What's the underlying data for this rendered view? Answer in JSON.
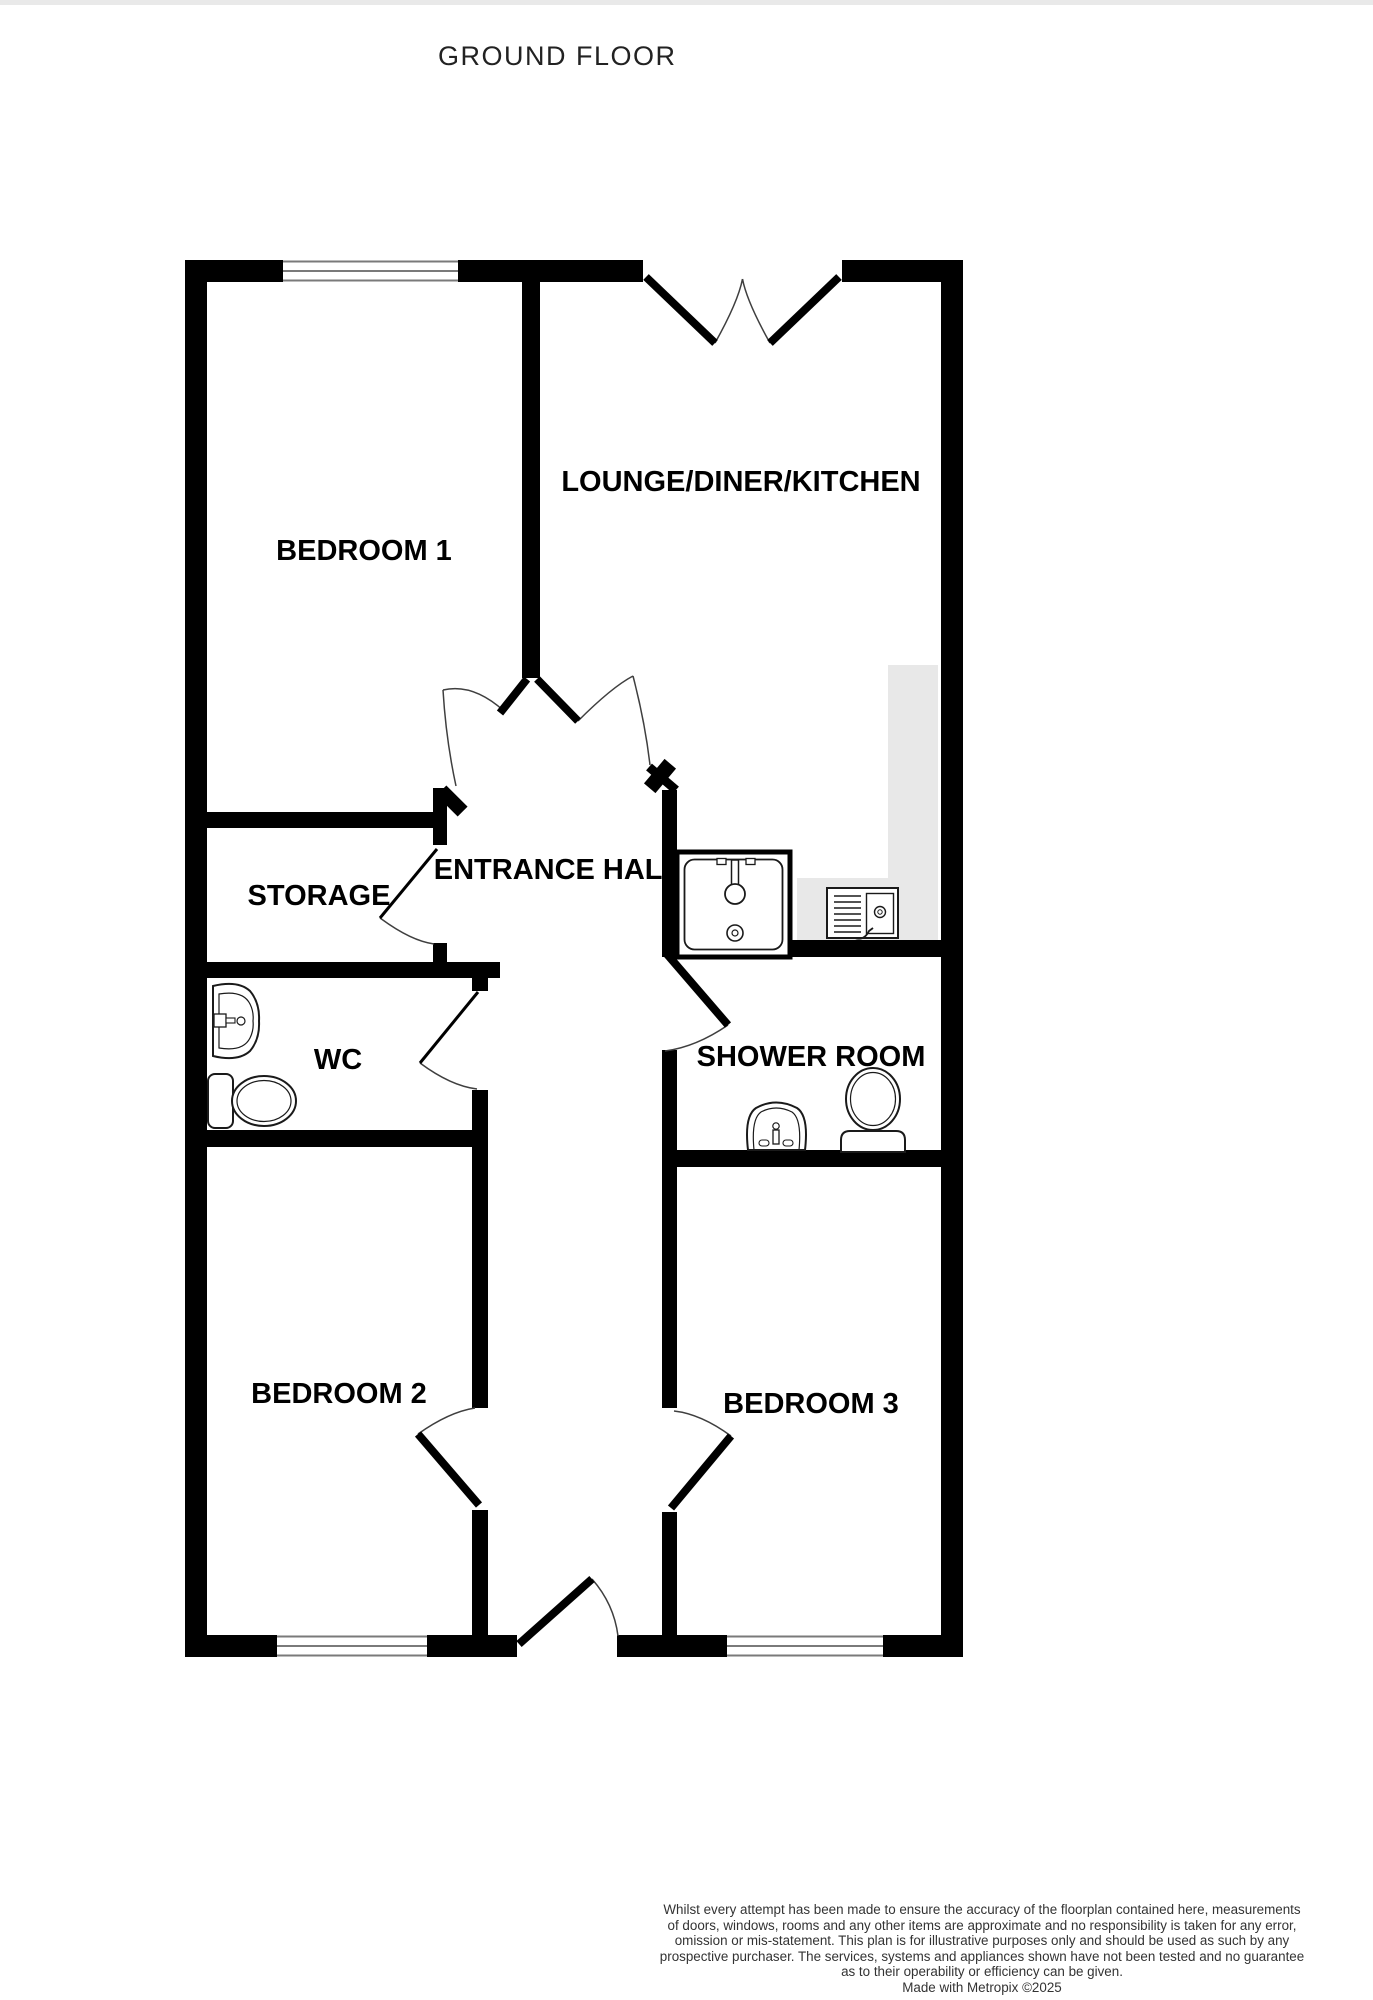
{
  "page": {
    "title": "GROUND FLOOR",
    "top_strip_color": "#e9e9e9"
  },
  "floorplan": {
    "colors": {
      "wall": "#000000",
      "arc": "#3f3f3f",
      "window_line": "#7a7a7a",
      "counter": "#e8e8e8",
      "fixture": "#1a1a1a"
    },
    "rooms": [
      {
        "id": "bedroom-1",
        "label": "BEDROOM 1",
        "x": 364,
        "y": 551
      },
      {
        "id": "lounge-diner-kitchen",
        "label": "LOUNGE/DINER/KITCHEN",
        "x": 741,
        "y": 482
      },
      {
        "id": "storage",
        "label": "STORAGE",
        "x": 319,
        "y": 896
      },
      {
        "id": "entrance-hall",
        "label": "ENTRANCE HALL",
        "x": 557,
        "y": 870
      },
      {
        "id": "wc",
        "label": "WC",
        "x": 338,
        "y": 1060
      },
      {
        "id": "shower-room",
        "label": "SHOWER ROOM",
        "x": 811,
        "y": 1057
      },
      {
        "id": "bedroom-2",
        "label": "BEDROOM 2",
        "x": 339,
        "y": 1394
      },
      {
        "id": "bedroom-3",
        "label": "BEDROOM 3",
        "x": 811,
        "y": 1404
      }
    ],
    "counters": [
      [
        888,
        665,
        50,
        275
      ],
      [
        797,
        878,
        141,
        62
      ]
    ],
    "windows": [
      [
        283,
        260,
        175,
        22
      ],
      [
        277,
        1635,
        150,
        22
      ],
      [
        727,
        1635,
        156,
        22
      ]
    ],
    "walls": [
      [
        185,
        260,
        22,
        1397
      ],
      [
        941,
        260,
        22,
        1397
      ],
      [
        185,
        260,
        98,
        22
      ],
      [
        458,
        260,
        185,
        22
      ],
      [
        842,
        260,
        121,
        22
      ],
      [
        185,
        1635,
        92,
        22
      ],
      [
        427,
        1635,
        90,
        22
      ],
      [
        617,
        1635,
        110,
        22
      ],
      [
        883,
        1635,
        80,
        22
      ],
      [
        522,
        282,
        18,
        396
      ],
      [
        185,
        812,
        262,
        16
      ],
      [
        433,
        788,
        14,
        57
      ],
      [
        433,
        943,
        14,
        19
      ],
      [
        185,
        962,
        315,
        16
      ],
      [
        472,
        978,
        16,
        13
      ],
      [
        185,
        1130,
        303,
        17
      ],
      [
        472,
        1090,
        16,
        318
      ],
      [
        472,
        1510,
        16,
        147
      ],
      [
        662,
        790,
        15,
        167
      ],
      [
        662,
        1050,
        15,
        358
      ],
      [
        662,
        1512,
        15,
        145
      ],
      [
        662,
        940,
        301,
        17
      ],
      [
        662,
        1150,
        301,
        17
      ]
    ],
    "angled_walls": [
      {
        "x": 452,
        "y": 801,
        "w": 30,
        "h": 14,
        "a": 45
      },
      {
        "x": 660,
        "y": 776,
        "w": 32,
        "h": 15,
        "a": -50
      }
    ],
    "doors": [
      {
        "name": "patio-door-left",
        "leaf": [
          646,
          277,
          715,
          343
        ],
        "lw": 8,
        "arc": "M715,343 Q738,302 742.5,279"
      },
      {
        "name": "patio-door-right",
        "leaf": [
          839,
          277,
          770,
          343
        ],
        "lw": 8,
        "arc": "M770,343 Q747,302 742.5,279"
      },
      {
        "name": "bedroom-1-door",
        "leaf": [
          527,
          679,
          500,
          713
        ],
        "lw": 8,
        "arc": "M443,690 Q473,683 504,711"
      },
      {
        "name": "bedroom-1-door-swing",
        "arc": "M443,690 Q446,740 456,786"
      },
      {
        "name": "lounge-door",
        "leaf": [
          537,
          679,
          578,
          721
        ],
        "lw": 8,
        "arc": "M578,721 Q612,687 633,676"
      },
      {
        "name": "kitchen-door",
        "leaf": [
          649,
          767,
          676,
          790
        ],
        "lw": 9,
        "arc": "M633,676 Q645,722 650,765"
      },
      {
        "name": "storage-door",
        "leaf": [
          437,
          849,
          380,
          918
        ],
        "lw": 3,
        "arc": "M380,918 Q411,941 434,944"
      },
      {
        "name": "wc-door",
        "leaf": [
          478,
          992,
          420,
          1063
        ],
        "lw": 3,
        "arc": "M420,1063 Q451,1086 477,1089"
      },
      {
        "name": "shower-room-door",
        "leaf": [
          666,
          953,
          728,
          1025
        ],
        "lw": 8,
        "arc": "M728,1025 Q696,1047 665,1051"
      },
      {
        "name": "bedroom-2-door",
        "leaf": [
          479,
          1505,
          418,
          1434
        ],
        "lw": 8,
        "arc": "M418,1434 Q449,1412 475,1408"
      },
      {
        "name": "bedroom-3-door",
        "leaf": [
          671,
          1508,
          731,
          1436
        ],
        "lw": 8,
        "arc": "M731,1436 Q701,1414 674,1411"
      },
      {
        "name": "front-door",
        "leaf": [
          519,
          1644,
          592,
          1579
        ],
        "lw": 8,
        "arc": "M592,1579 Q614,1604 618,1636"
      }
    ],
    "fixtures": [
      {
        "name": "kitchen-sink",
        "shapes": [
          {
            "t": "rect",
            "x": 677,
            "y": 852,
            "w": 113,
            "h": 105,
            "fill": "#ffffff",
            "s": "#000000",
            "sw": 5
          },
          {
            "t": "rect",
            "x": 684.5,
            "y": 859.5,
            "w": 98,
            "h": 90,
            "rx": 10,
            "fill": "#ffffff",
            "sw": 1.8
          },
          {
            "t": "rect",
            "x": 717,
            "y": 858.5,
            "w": 9,
            "h": 6,
            "fill": "#ffffff",
            "sw": 1.3
          },
          {
            "t": "rect",
            "x": 746,
            "y": 858.5,
            "w": 9,
            "h": 6,
            "fill": "#ffffff",
            "sw": 1.3
          },
          {
            "t": "rect",
            "x": 731.5,
            "y": 860,
            "w": 7,
            "h": 25,
            "fill": "#ffffff",
            "sw": 1.5
          },
          {
            "t": "circle",
            "cx": 735,
            "cy": 894,
            "r": 10,
            "fill": "#ffffff",
            "sw": 1.8
          },
          {
            "t": "circle",
            "cx": 735,
            "cy": 933,
            "r": 8,
            "fill": "#ffffff",
            "sw": 1.6
          },
          {
            "t": "circle",
            "cx": 735,
            "cy": 933,
            "r": 3,
            "fill": "none",
            "sw": 1.2
          }
        ]
      },
      {
        "name": "washing-machine",
        "shapes": [
          {
            "t": "rect",
            "x": 827,
            "y": 888,
            "w": 71,
            "h": 50,
            "fill": "#ffffff",
            "sw": 2
          },
          {
            "t": "line",
            "x1": 834,
            "y1": 896,
            "x2": 861,
            "y2": 896,
            "sw": 1.4
          },
          {
            "t": "line",
            "x1": 834,
            "y1": 902,
            "x2": 861,
            "y2": 902,
            "sw": 1.4
          },
          {
            "t": "line",
            "x1": 834,
            "y1": 908,
            "x2": 861,
            "y2": 908,
            "sw": 1.4
          },
          {
            "t": "line",
            "x1": 834,
            "y1": 914,
            "x2": 861,
            "y2": 914,
            "sw": 1.4
          },
          {
            "t": "line",
            "x1": 834,
            "y1": 920,
            "x2": 861,
            "y2": 920,
            "sw": 1.4
          },
          {
            "t": "line",
            "x1": 834,
            "y1": 926,
            "x2": 861,
            "y2": 926,
            "sw": 1.4
          },
          {
            "t": "line",
            "x1": 834,
            "y1": 932,
            "x2": 861,
            "y2": 932,
            "sw": 1.4
          },
          {
            "t": "rect",
            "x": 866.5,
            "y": 893.5,
            "w": 27,
            "h": 40,
            "fill": "#ffffff",
            "sw": 1.4
          },
          {
            "t": "circle",
            "cx": 880,
            "cy": 912,
            "r": 5.5,
            "fill": "#ffffff",
            "sw": 1.4
          },
          {
            "t": "circle",
            "cx": 880,
            "cy": 912,
            "r": 2.2,
            "fill": "none",
            "sw": 1
          },
          {
            "t": "path",
            "d": "M855,938 q9,3 14,-7 l4,-3",
            "fill": "none",
            "sw": 1.8
          }
        ]
      },
      {
        "name": "wc-basin",
        "shapes": [
          {
            "t": "path",
            "d": "M213,986 Q238,980 250,991 Q260,1003 259,1021 Q260,1039 250,1051 Q238,1062 213,1056 Z",
            "fill": "#ffffff",
            "sw": 2
          },
          {
            "t": "path",
            "d": "M219,994 Q243,990 250,1004 Q254,1012 253,1021 Q254,1030 250,1038 Q243,1052 219,1048 Z",
            "fill": "#ffffff",
            "sw": 1.2
          },
          {
            "t": "rect",
            "x": 214,
            "y": 1014,
            "w": 12,
            "h": 13,
            "fill": "#ffffff",
            "sw": 1.3
          },
          {
            "t": "rect",
            "x": 226,
            "y": 1018,
            "w": 9,
            "h": 5,
            "fill": "#ffffff",
            "sw": 1.1
          },
          {
            "t": "circle",
            "cx": 241,
            "cy": 1021,
            "r": 4,
            "fill": "#ffffff",
            "sw": 1.2
          }
        ]
      },
      {
        "name": "wc-toilet",
        "shapes": [
          {
            "t": "rect",
            "x": 208,
            "y": 1074,
            "w": 25,
            "h": 54,
            "rx": 7,
            "fill": "#ffffff",
            "sw": 2
          },
          {
            "t": "ellipse",
            "cx": 264,
            "cy": 1101,
            "rx": 32,
            "ry": 25,
            "fill": "#ffffff",
            "sw": 2
          },
          {
            "t": "ellipse",
            "cx": 264,
            "cy": 1101,
            "rx": 27,
            "ry": 20.5,
            "fill": "none",
            "sw": 1.2
          }
        ]
      },
      {
        "name": "shower-room-basin",
        "shapes": [
          {
            "t": "path",
            "d": "M748,1150 Q744,1116 756,1108 Q776,1097 797,1108 Q809,1116 805,1150 Z",
            "fill": "#ffffff",
            "sw": 2
          },
          {
            "t": "path",
            "d": "M754,1150 Q751,1119 761,1112 Q776,1104 792,1112 Q802,1119 799,1150 Z",
            "fill": "none",
            "sw": 1.2
          },
          {
            "t": "rect",
            "x": 773,
            "y": 1130,
            "w": 6,
            "h": 14,
            "fill": "#ffffff",
            "sw": 1.3
          },
          {
            "t": "circle",
            "cx": 776,
            "cy": 1126,
            "r": 3.2,
            "fill": "#ffffff",
            "sw": 1.2
          },
          {
            "t": "rect",
            "x": 759,
            "y": 1140,
            "w": 10,
            "h": 6,
            "rx": 3,
            "fill": "#ffffff",
            "sw": 1.1
          },
          {
            "t": "rect",
            "x": 783,
            "y": 1140,
            "w": 10,
            "h": 6,
            "rx": 3,
            "fill": "#ffffff",
            "sw": 1.1
          }
        ]
      },
      {
        "name": "shower-room-toilet",
        "shapes": [
          {
            "t": "ellipse",
            "cx": 873,
            "cy": 1099,
            "rx": 27,
            "ry": 31,
            "fill": "#ffffff",
            "sw": 2
          },
          {
            "t": "ellipse",
            "cx": 873,
            "cy": 1099,
            "rx": 22.5,
            "ry": 26.5,
            "fill": "none",
            "sw": 1.2
          },
          {
            "t": "path",
            "d": "M841,1152 L841,1140 Q841,1131 850,1131 L896,1131 Q905,1131 905,1140 L905,1152 Z",
            "fill": "#ffffff",
            "sw": 2
          }
        ]
      }
    ]
  },
  "disclaimer": {
    "lines": [
      "Whilst every attempt has been made to ensure the accuracy of the floorplan contained here, measurements",
      "of doors, windows, rooms and any other items are approximate and no responsibility is taken for any error,",
      "omission or mis-statement. This plan is for illustrative purposes only and should be used as such by any",
      "prospective purchaser. The services, systems and appliances shown have not been tested and no guarantee",
      "as to their operability or efficiency can be given."
    ],
    "credit": "Made with Metropix ©2025"
  }
}
